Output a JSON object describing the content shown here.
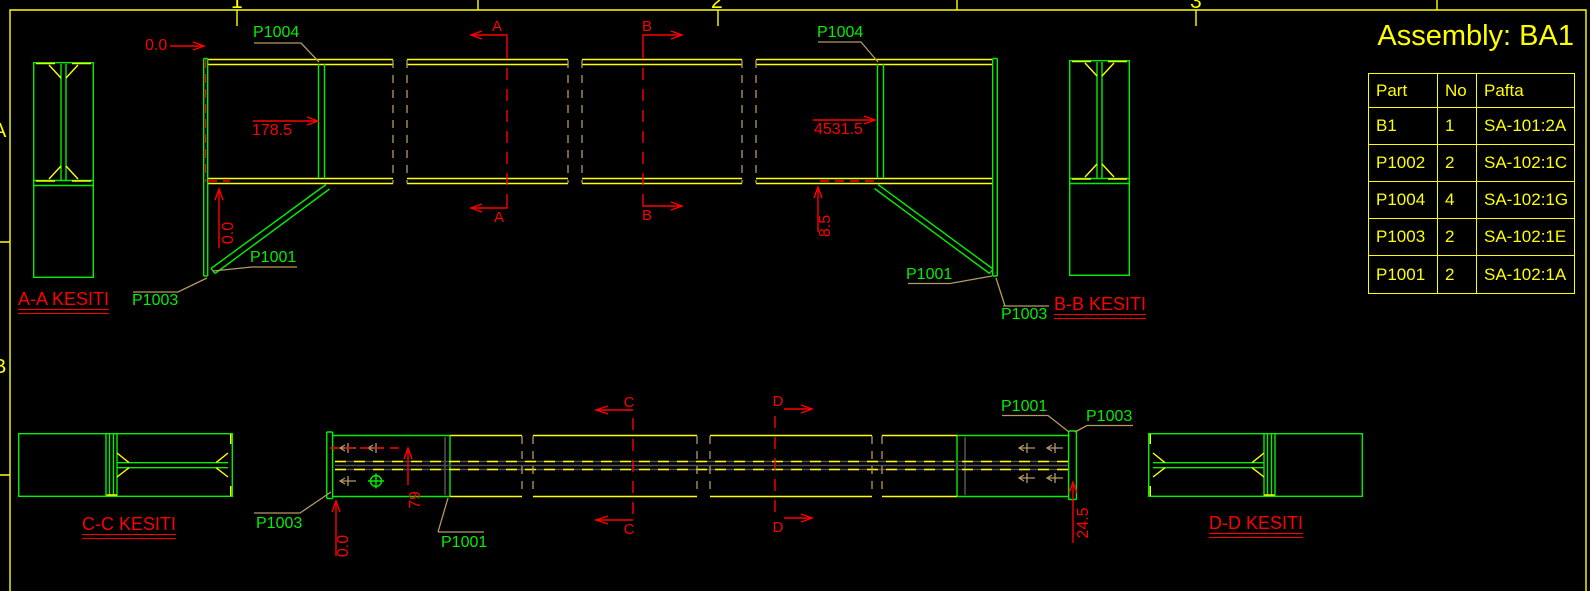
{
  "sheet": {
    "grid_cols": [
      "1",
      "2",
      "3"
    ],
    "grid_rows": [
      "A",
      "B"
    ]
  },
  "title_block": {
    "title": "Assembly: BA1",
    "table": {
      "headers": [
        "Part",
        "No",
        "Pafta"
      ],
      "rows": [
        [
          "B1",
          "1",
          "SA-101:2A"
        ],
        [
          "P1002",
          "2",
          "SA-102:1C"
        ],
        [
          "P1004",
          "4",
          "SA-102:1G"
        ],
        [
          "P1003",
          "2",
          "SA-102:1E"
        ],
        [
          "P1001",
          "2",
          "SA-102:1A"
        ]
      ]
    }
  },
  "labels": {
    "p1001": "P1001",
    "p1003": "P1003",
    "p1004": "P1004"
  },
  "sections": {
    "a": "A",
    "b": "B",
    "c": "C",
    "d": "D",
    "aa_caption": "A-A KESITI",
    "bb_caption": "B-B KESITI",
    "cc_caption": "C-C KESITI",
    "dd_caption": "D-D KESITI"
  },
  "dims": {
    "front_zero_top": "0.0",
    "front_stiffener_left": "178.5",
    "front_stiffener_right": "4531.5",
    "front_brace_offset": "8.5",
    "front_zero_bottom": "0.0",
    "plan_zero": "0.0",
    "plan_bolt_row": "79",
    "plan_end_offset": "24.5"
  },
  "colors": {
    "background": "#000000",
    "outline_yellow": "#ffff00",
    "part_green": "#00f000",
    "annotation_red": "#ff0000",
    "leader_tan": "#b59a62",
    "hidden_gray": "#505050"
  }
}
